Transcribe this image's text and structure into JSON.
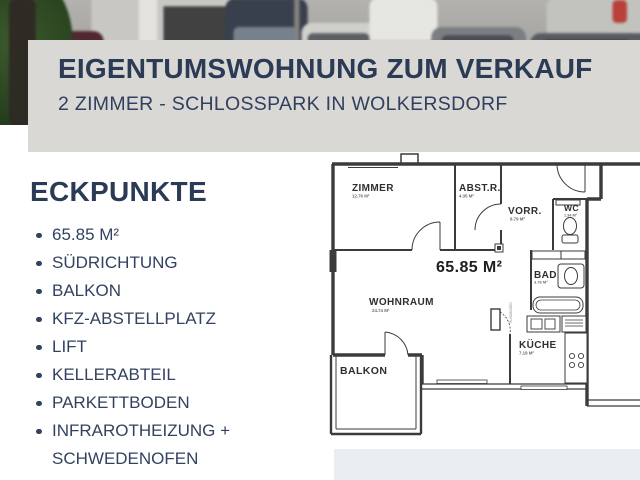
{
  "banner": {
    "title": "EIGENTUMSWOHNUNG ZUM VERKAUF",
    "subtitle": "2 ZIMMER - SCHLOSSPARK IN WOLKERSDORF"
  },
  "eckpunkte": {
    "heading": "ECKPUNKTE",
    "items": [
      "65.85 M²",
      "SÜDRICHTUNG",
      "BALKON",
      "KFZ-ABSTELLPLATZ",
      "LIFT",
      "KELLERABTEIL",
      "PARKETTBODEN",
      "INFRAROTHEIZUNG + SCHWEDENOFEN"
    ]
  },
  "floorplan": {
    "total_area": "65.85 M²",
    "annotation": "RUNDBOGEN",
    "rooms": [
      {
        "name": "ZIMMER",
        "area": "12.76 M²"
      },
      {
        "name": "ABST.R.",
        "area": "4.35 M²"
      },
      {
        "name": "VORR.",
        "area": "8.79 M²"
      },
      {
        "name": "WC",
        "area": "1.34 M²"
      },
      {
        "name": "BAD",
        "area": "3.76 M²"
      },
      {
        "name": "KÜCHE",
        "area": "7.19 M²"
      },
      {
        "name": "WOHNRAUM",
        "area": "24.74 M²"
      },
      {
        "name": "BALKON",
        "area": ""
      }
    ]
  },
  "colors": {
    "accent_navy": "#2b3a55",
    "banner_bg": "#d9d8d5",
    "footer_band": "#e9eef3",
    "plan_line": "#3b3b3b"
  }
}
